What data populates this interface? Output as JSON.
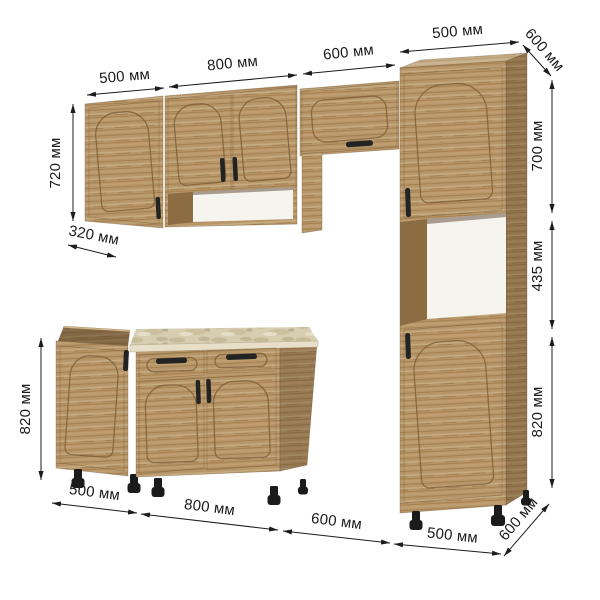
{
  "unit": "мм",
  "dimensions": {
    "top": {
      "wall_cabinet_left_width": {
        "value": 500,
        "unit": "мм",
        "text": "500 мм"
      },
      "wall_cabinet_mid_width": {
        "value": 800,
        "unit": "мм",
        "text": "800 мм"
      },
      "hood_cabinet_width": {
        "value": 600,
        "unit": "мм",
        "text": "600 мм"
      },
      "tall_cabinet_width": {
        "value": 500,
        "unit": "мм",
        "text": "500 мм"
      },
      "tall_cabinet_depth": {
        "value": 600,
        "unit": "мм",
        "text": "600 мм"
      }
    },
    "left": {
      "wall_cabinet_height": {
        "value": 720,
        "unit": "мм",
        "text": "720 мм"
      },
      "wall_cabinet_depth": {
        "value": 320,
        "unit": "мм",
        "text": "320 мм"
      },
      "base_cabinet_height": {
        "value": 820,
        "unit": "мм",
        "text": "820 мм"
      }
    },
    "right": {
      "tall_upper_section_height": {
        "value": 700,
        "unit": "мм",
        "text": "700 мм"
      },
      "tall_niche_height": {
        "value": 435,
        "unit": "мм",
        "text": "435 мм"
      },
      "tall_lower_section_height": {
        "value": 820,
        "unit": "мм",
        "text": "820 мм"
      }
    },
    "bottom": {
      "base_cabinet_left_width": {
        "value": 500,
        "unit": "мм",
        "text": "500 мм"
      },
      "base_cabinet_mid_width": {
        "value": 800,
        "unit": "мм",
        "text": "800 мм"
      },
      "appliance_gap_width": {
        "value": 600,
        "unit": "мм",
        "text": "600 мм"
      },
      "tall_cabinet_width": {
        "value": 500,
        "unit": "мм",
        "text": "500 мм"
      },
      "tall_cabinet_depth": {
        "value": 600,
        "unit": "мм",
        "text": "600 мм"
      }
    }
  },
  "colors": {
    "background": "#ffffff",
    "wood": "#b7966a",
    "wood_dark": "#8c6c42",
    "countertop": "#d7cdb0",
    "handles": "#232323",
    "dimension_lines": "#1c1c1c",
    "niche_back": "#f6f4ee"
  }
}
